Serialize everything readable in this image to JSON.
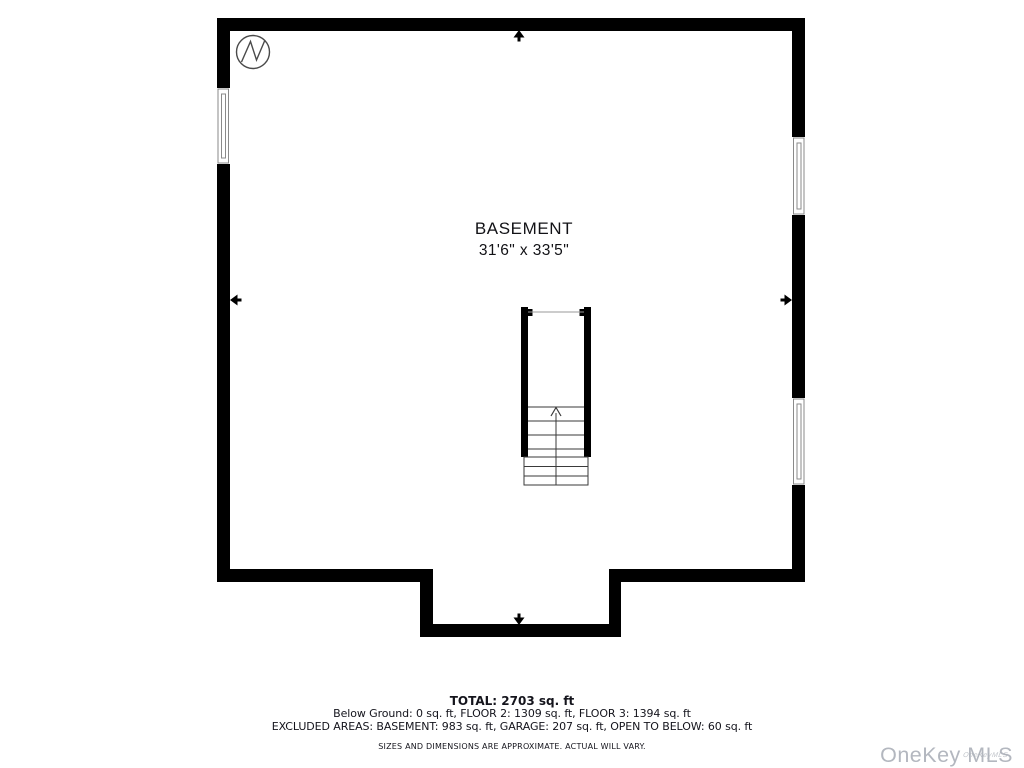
{
  "floorplan": {
    "room": {
      "label": "BASEMENT",
      "dimensions": "31'6\" x 33'5\""
    },
    "features": {
      "stairs": "staircase with up arrow, center of plan",
      "windows": [
        "left wall window",
        "right wall upper window",
        "right wall lower window"
      ],
      "entry_markers": [
        "top",
        "left",
        "right",
        "bottom"
      ]
    },
    "colors": {
      "wall": "#000000",
      "background": "#ffffff",
      "stair_line": "#3a3a3a",
      "window_frame": "#8a8a8a",
      "compass_stroke": "#4a4a4a"
    }
  },
  "icons": {
    "compass": "compass-north-icon",
    "wall_arrows": "wall-arrow-icon"
  },
  "summary": {
    "total": "TOTAL: 2703 sq. ft",
    "breakdown": "Below Ground: 0 sq. ft, FLOOR 2: 1309 sq. ft, FLOOR 3: 1394 sq. ft",
    "excluded": "EXCLUDED AREAS: BASEMENT: 983 sq. ft, GARAGE: 207 sq. ft, OPEN TO BELOW: 60 sq. ft",
    "disclaimer": "SIZES AND DIMENSIONS ARE APPROXIMATE. ACTUAL WILL VARY."
  },
  "watermark": {
    "brand": "OneKey MLS",
    "small_text": "OneKeyMLS",
    "color": "#b3b7bf"
  }
}
